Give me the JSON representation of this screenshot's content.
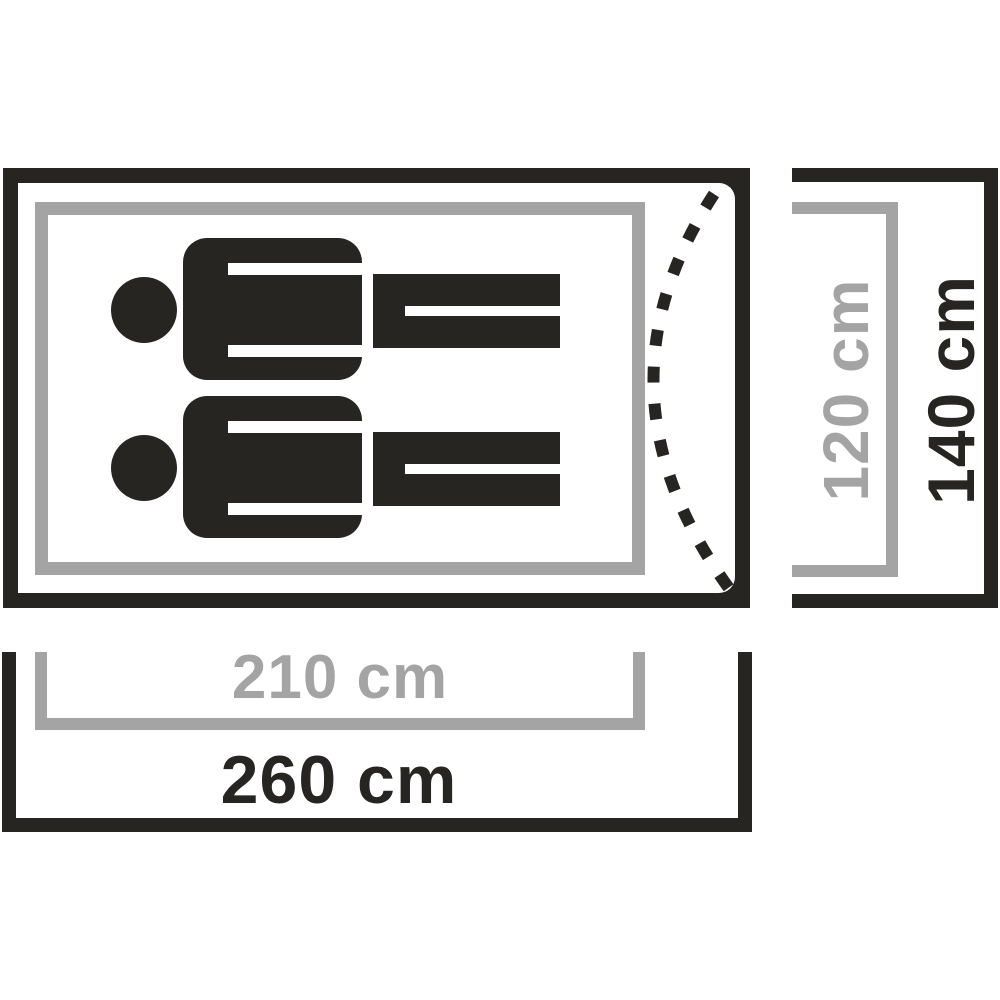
{
  "diagram": {
    "type": "tent-floorplan-top-view",
    "colors": {
      "ink": "#262522",
      "muted_gray": "#a4a4a4",
      "background": "#ffffff"
    },
    "dimensions": {
      "inner_width": {
        "label": "210 cm",
        "value": 210,
        "unit": "cm"
      },
      "outer_width": {
        "label": "260 cm",
        "value": 260,
        "unit": "cm"
      },
      "inner_depth": {
        "label": "120 cm",
        "value": 120,
        "unit": "cm"
      },
      "outer_depth": {
        "label": "140 cm",
        "value": 140,
        "unit": "cm"
      }
    },
    "occupants": {
      "count": 2,
      "icon": "person-lying-icon"
    },
    "door": {
      "style": "dashed-arc"
    }
  }
}
